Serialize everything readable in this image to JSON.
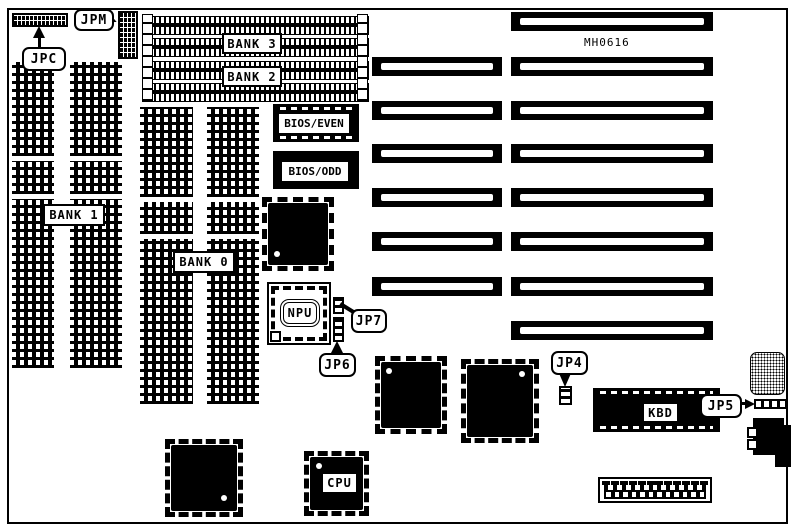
{
  "colors": {
    "ink": "#000000",
    "paper": "#ffffff"
  },
  "board": {
    "part_number": "MH0616"
  },
  "memory": {
    "bank3_label": "BANK 3",
    "bank2_label": "BANK 2",
    "bank1_label": "BANK 1",
    "bank0_label": "BANK 0",
    "simm_socket_count": 4,
    "dram_column_count": 4
  },
  "chips": {
    "bios_even_label": "BIOS/EVEN",
    "bios_odd_label": "BIOS/ODD",
    "npu_label": "NPU",
    "cpu_label": "CPU",
    "kbd_label": "KBD"
  },
  "jumpers": {
    "jpc_label": "JPC",
    "jpm_label": "JPM",
    "jp7_label": "JP7",
    "jp6_label": "JP6",
    "jp5_label": "JP5",
    "jp4_label": "JP4"
  },
  "expansion_slots": {
    "long_slot_count": 8,
    "short_slot_count": 6
  },
  "power_connector": {
    "pin_count": 12
  }
}
